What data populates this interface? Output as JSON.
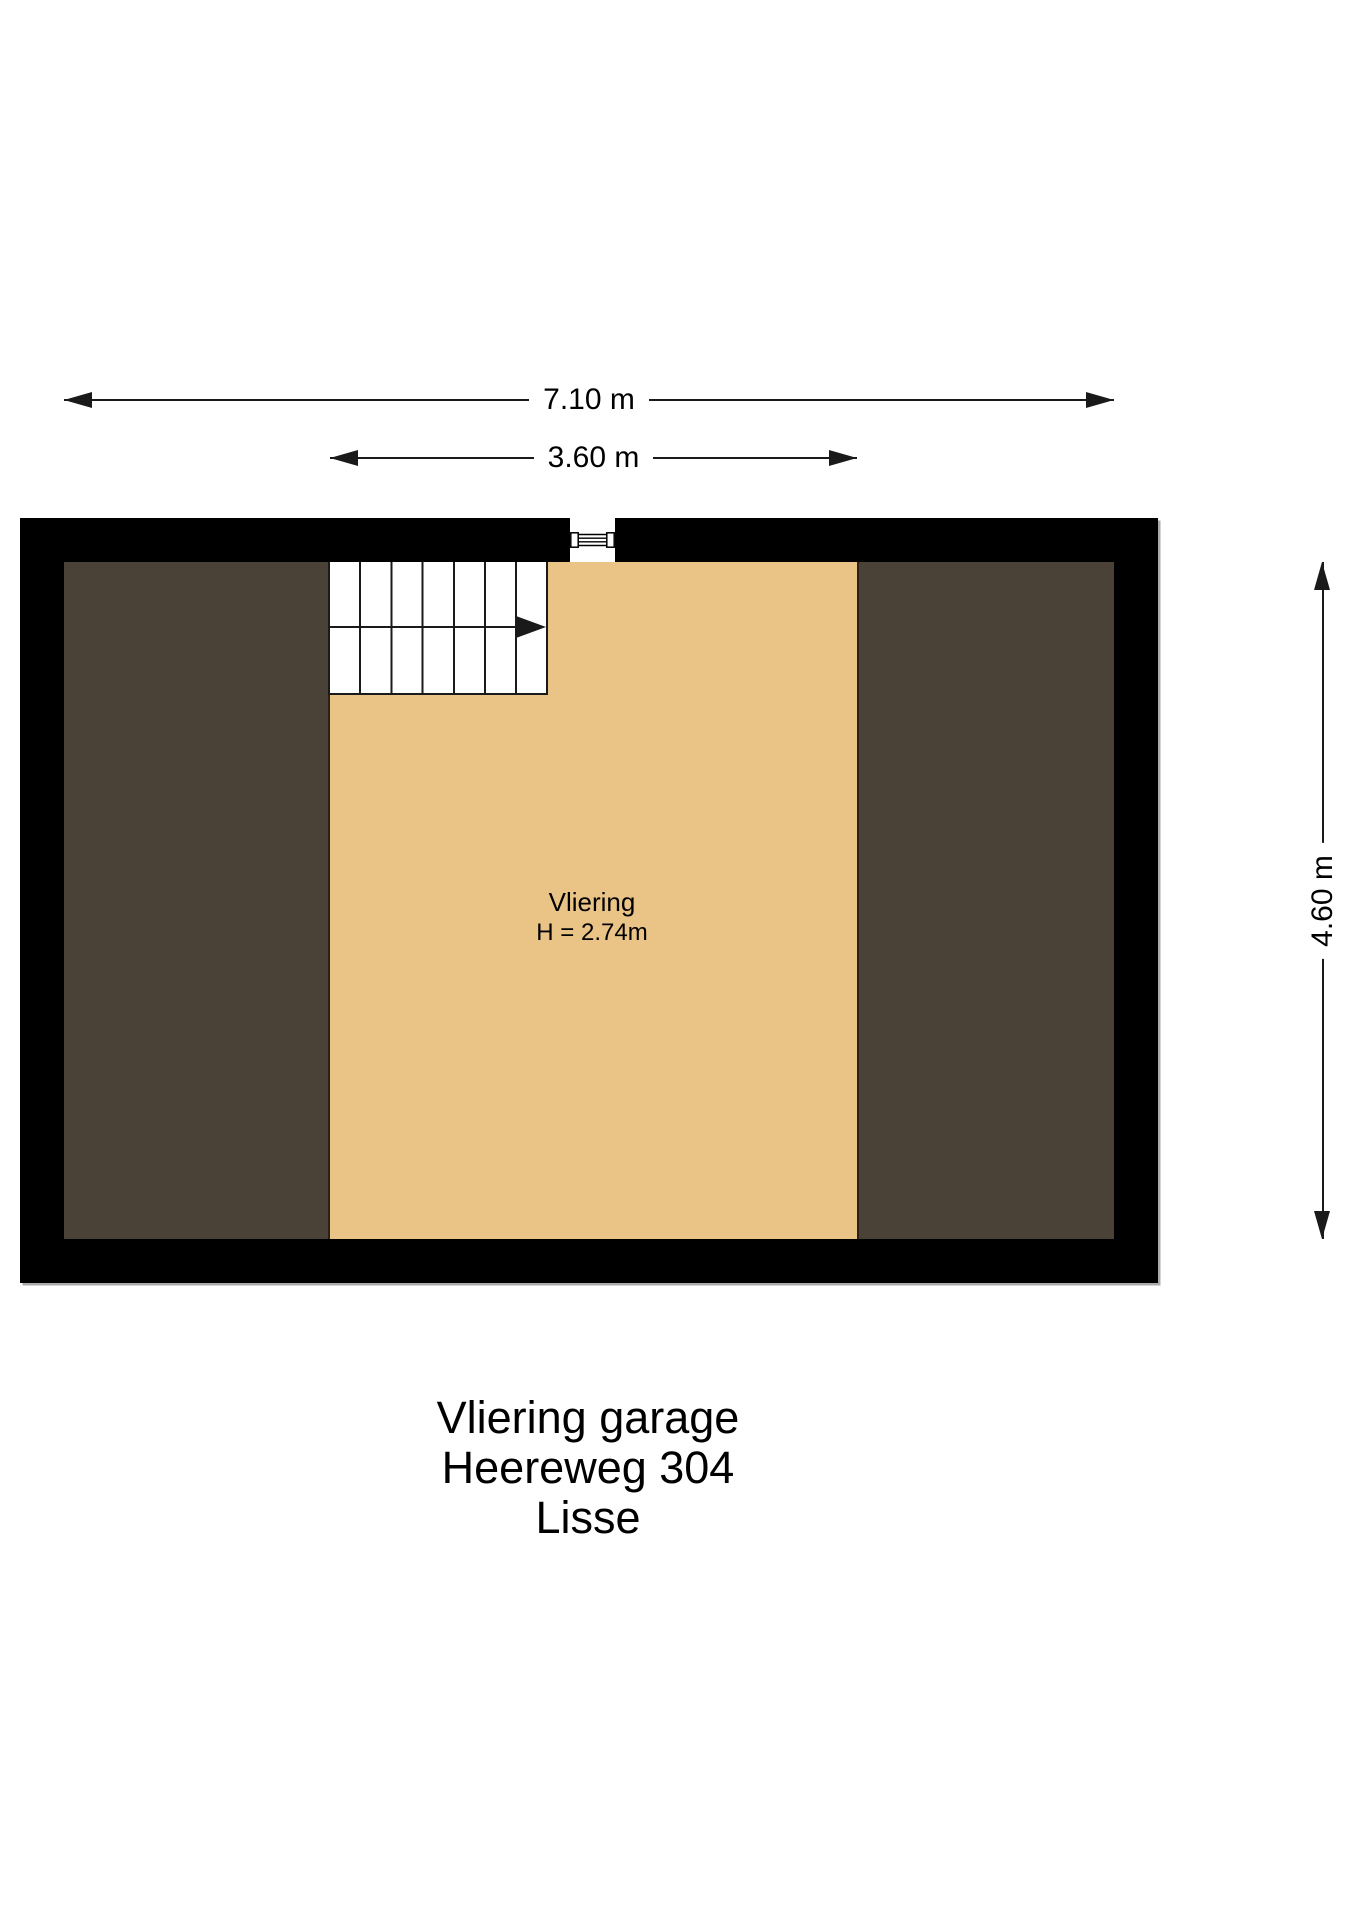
{
  "dimensions": {
    "overall_width": {
      "label": "7.10 m"
    },
    "vliering_width": {
      "label": "3.60 m"
    },
    "overall_depth": {
      "label": "4.60 m"
    }
  },
  "room": {
    "name": "Vliering",
    "height_note": "H = 2.74m"
  },
  "icons": {
    "hatch": "roof-hatch-ladder-icon",
    "stair_direction": "stair-direction-arrow-icon"
  },
  "title_block": {
    "lines": [
      "Vliering garage",
      "Heereweg 304",
      "Lisse"
    ]
  },
  "colors": {
    "wall": "#000000",
    "floor_light": "#eac387",
    "floor_dark": "#4a4137",
    "line": "#1a1a1a",
    "boundary": "#2b2118"
  }
}
